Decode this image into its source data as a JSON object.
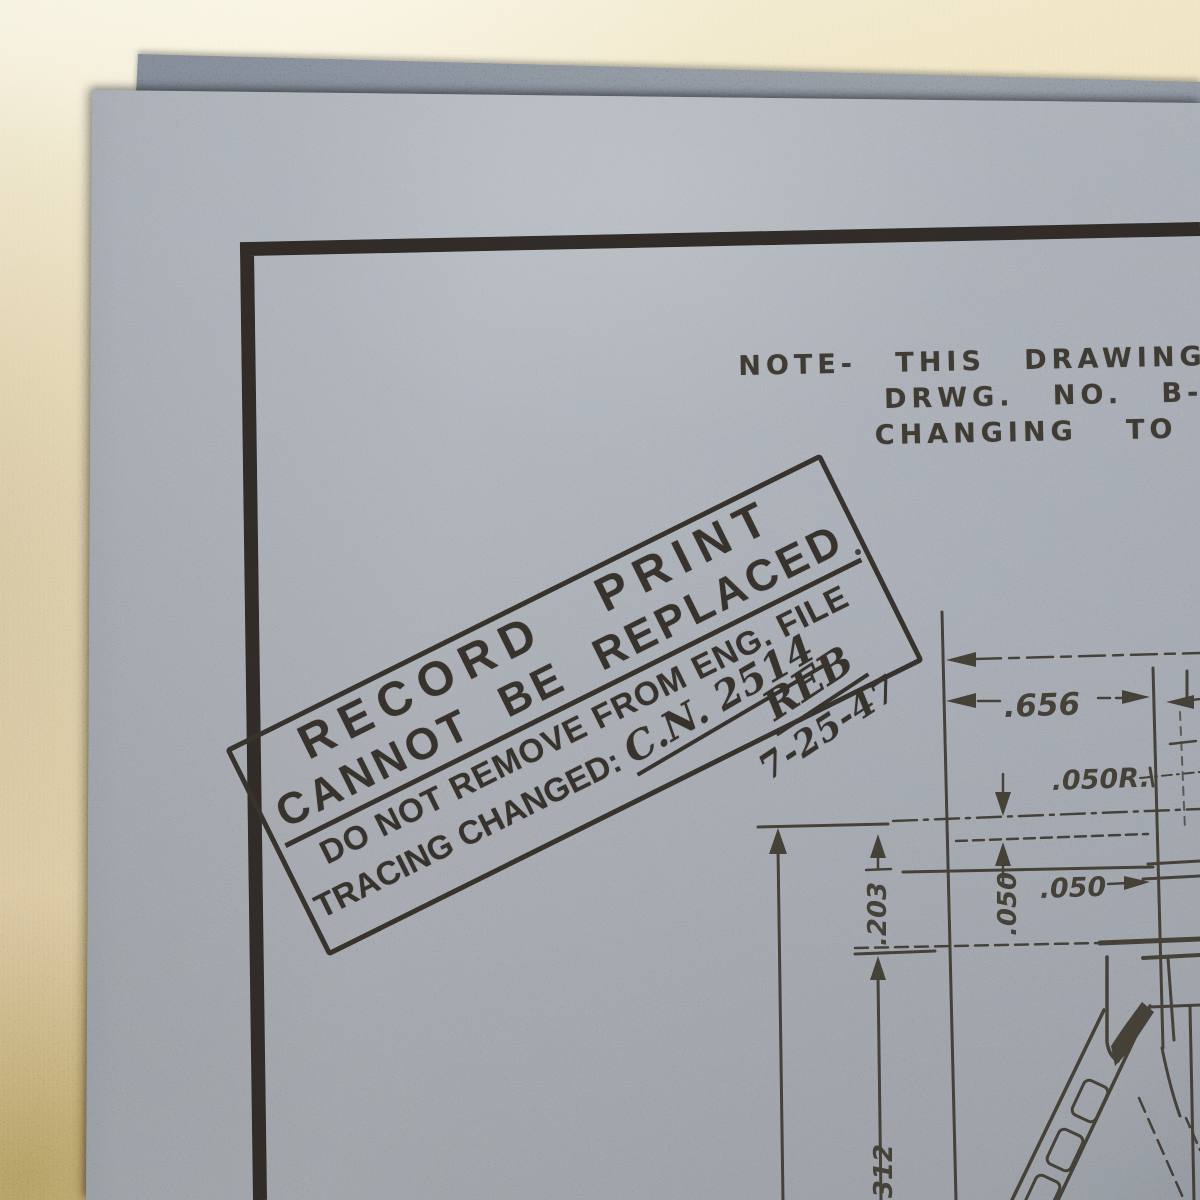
{
  "note": {
    "line1": "NOTE- THIS DRAWING W",
    "line2": "DRWG. NO. B-35",
    "line3": "CHANGING TO"
  },
  "stamp": {
    "title": "RECORD PRINT",
    "cannot_line": "CANNOT BE REPLACED",
    "remove_line": "DO NOT REMOVE FROM ENG. FILE",
    "tracing_label": "TRACING CHANGED:",
    "tracing_value": "C.N. 2514",
    "initials": "REB",
    "date": "7-25-47"
  },
  "drawing_dimensions": {
    "width_656": ".656",
    "radius_050": ".050R.",
    "gap_050_horizontal": ".050",
    "gap_050_vertical": ".050",
    "depth_203": ".203",
    "depth_312": ".312"
  },
  "colors": {
    "fabric_backdrop": "#e2d0a0",
    "paper_front": "#959ba3",
    "paper_under": "#747a83",
    "handwriting_ink": "#332f28",
    "stamp_ink": "#2c2823",
    "drawing_ink": "#38342c"
  }
}
